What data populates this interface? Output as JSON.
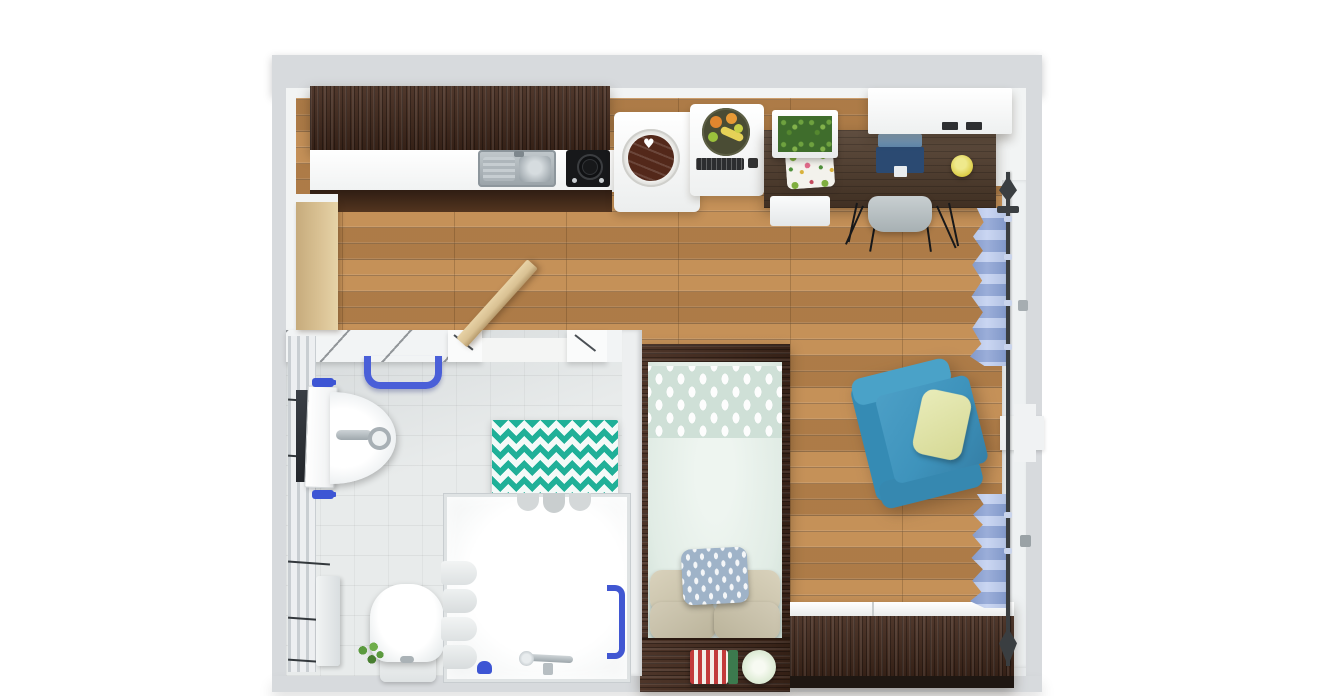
{
  "scene": {
    "type": "3d-floorplan-top-view",
    "room_count": 2
  },
  "glyphs": {
    "heart": "♥"
  },
  "palette": {
    "wall_outer": "#d7dadd",
    "wall_face": "#f2f4f4",
    "floor_wood": "#b9854f",
    "bath_floor": "#e8ebeb",
    "bath_wall": "#f3f5f6",
    "dark_wood": "#43291c",
    "desk_wood": "#4e3a2a",
    "counter_white": "#fafbfb",
    "sink_steel": "#a9b2b7",
    "cooktop_black": "#17181a",
    "washer_drum": "#53281a",
    "bed_mint": "#e1ece5",
    "pillow_beige": "#cdc5ae",
    "pillow_pattern": "#9fb3c8",
    "armchair_blue": "#3e93bc",
    "throw_pillow": "#dfe3a9",
    "curtain_blue": "#a7bbe2",
    "rod_dark": "#3a3e41",
    "towel_rail_blue": "#4a5fd8",
    "accent_blue": "#3d55d4",
    "mat_teal": "#1fb098",
    "door_tan": "#d9c193",
    "laptop_navy": "#2b4a72",
    "laptop_screen": "#7d9fc0",
    "lamp_yellow": "#d9c93e",
    "plant_green": "#4e8f3a",
    "chair_gray": "#bcc4c6",
    "sideboard_top": "#f5f6f6",
    "plate_sage": "#c8dcc0",
    "stripe_red": "#c23b3b",
    "stripe_green": "#3c7a4e"
  },
  "objects": {
    "kitchen": [
      "upper-cabinets",
      "countertop",
      "double-sink",
      "cooktop",
      "washing-machine",
      "oven",
      "fruit-bowl",
      "planter-box"
    ],
    "workspace": [
      "wall-shelf",
      "desk",
      "laptop",
      "desk-lamp",
      "seat-cushion",
      "desk-chair"
    ],
    "living": [
      "armchair",
      "throw-pillow",
      "curtain-rod",
      "upper-curtain",
      "lower-curtain",
      "window-pier"
    ],
    "sleeping": [
      "bed-frame",
      "duvet",
      "patterned-duvet-band",
      "beige-pillows",
      "accent-pillow",
      "footboard-shelf",
      "rolled-towels",
      "decor-plate",
      "sideboard"
    ],
    "bathroom": [
      "bathroom-door",
      "entry-door",
      "towel-rail",
      "wall-sink",
      "mirror",
      "faucet",
      "hand-towel",
      "toilet",
      "plant",
      "shower-enclosure",
      "shower-caddy",
      "shower-door-handle",
      "shower-head",
      "chevron-bath-mat",
      "slippers",
      "radiator-panel"
    ]
  }
}
